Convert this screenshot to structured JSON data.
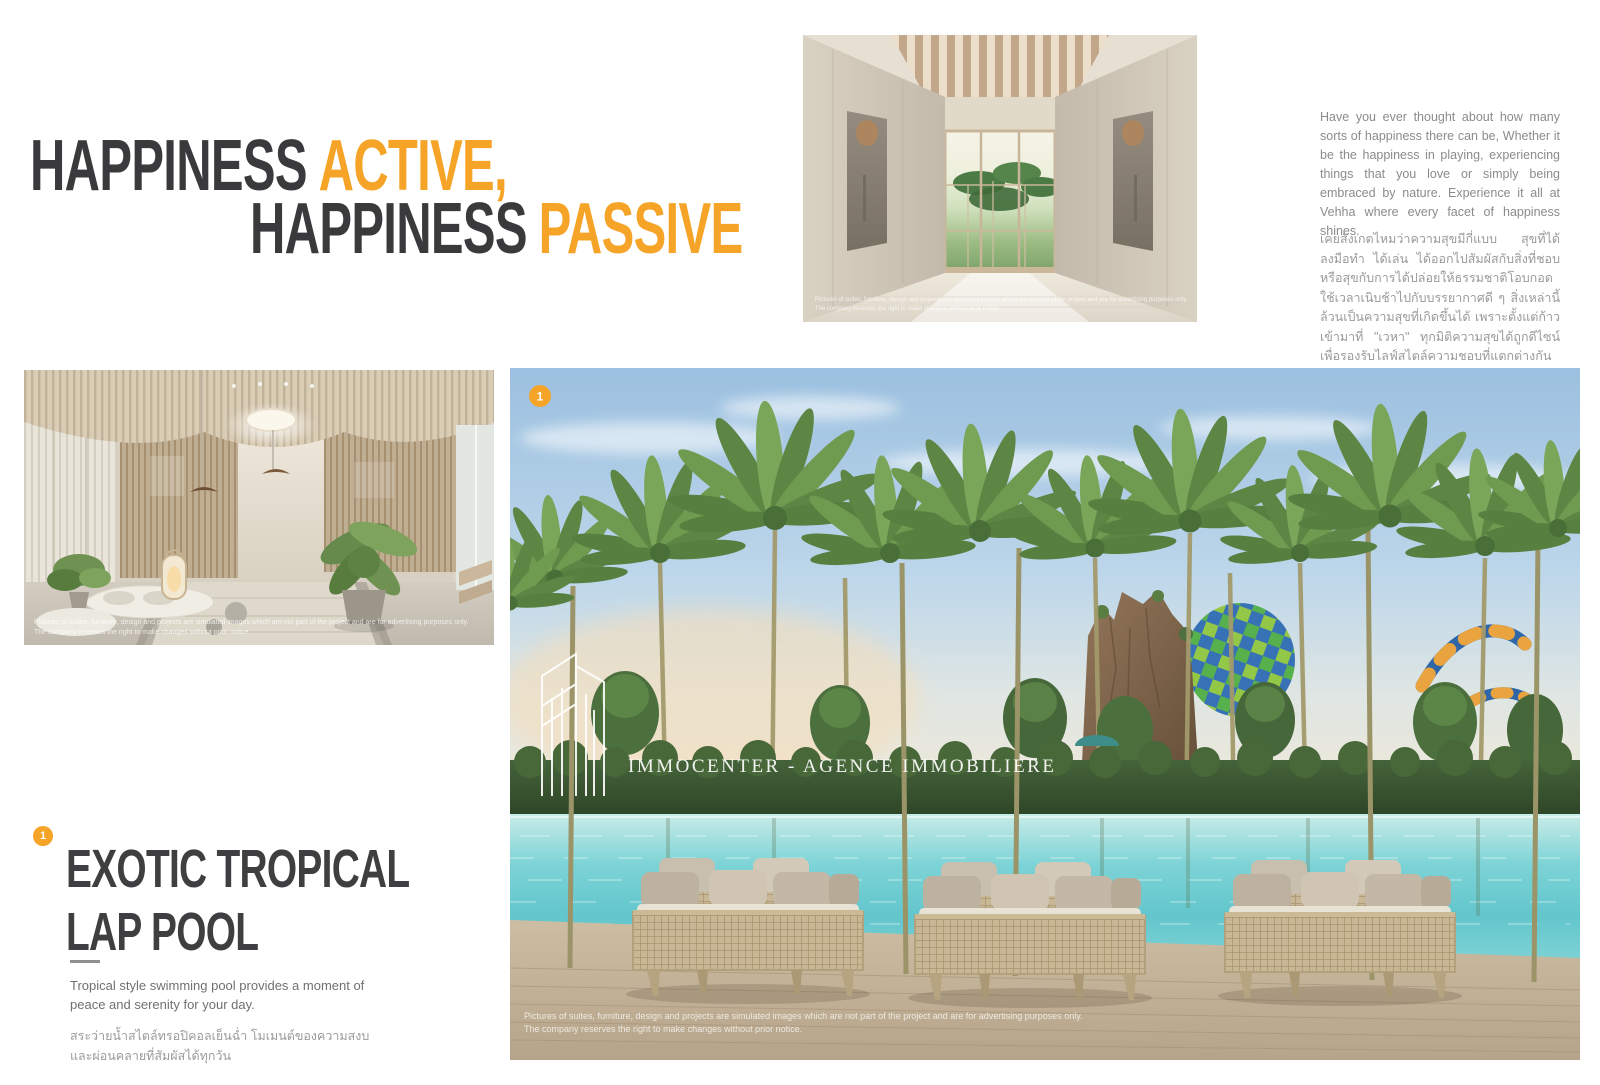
{
  "palette": {
    "accent_orange": "#f5a427",
    "headline_dark": "#3a3a3c",
    "pool_water": "#6fd0d4"
  },
  "headline": {
    "line1_dark": "HAPPINESS",
    "line1_orange": "ACTIVE,",
    "line2_dark": "HAPPINESS",
    "line2_orange": "PASSIVE"
  },
  "intro": {
    "english": "Have you ever thought about how many sorts of happiness there can be, Whether it be the happiness in playing, experiencing things that you love or simply being embraced by nature. Experience it all at Vehha where every facet of happiness shines.",
    "thai": "เคยสังเกตไหมว่าความสุขมีกี่แบบ สุขที่ได้ลงมือทำ ได้เล่น ได้ออกไปสัมผัสกับสิ่งที่ชอบ หรือสุขกับการได้ปล่อยให้ธรรมชาติโอบกอด ใช้เวลาเนิบช้าไปกับบรรยากาศดี ๆ สิ่งเหล่านี้ล้วนเป็นความสุขที่เกิดขึ้นได้ เพราะตั้งแต่ก้าวเข้ามาที่ \"เวหา\" ทุกมิติความสุขได้ถูกดีไซน์เพื่อรองรับไลฟ์สไตล์ความชอบที่แตกต่างกันอย่างครบถ้วน"
  },
  "watermark": {
    "text": "IMMOCENTER - AGENCE IMMOBILIERE"
  },
  "disclaimer": {
    "line1": "Pictures of suites, furniture, design and projects are simulated images which are not part of the project and are for advertising purposes only.",
    "line2": "The company reserves the right to make changes without prior notice."
  },
  "pool_image": {
    "badge": "1"
  },
  "feature": {
    "badge": "1",
    "title_line1": "EXOTIC TROPICAL",
    "title_line2": "LAP POOL",
    "english": "Tropical style swimming pool provides a moment of peace and serenity for your day.",
    "thai_line1": "สระว่ายน้ำสไตล์ทรอปิคอลเย็นฉ่ำ โมเมนต์ของความสงบ",
    "thai_line2": "และผ่อนคลายที่สัมผัสได้ทุกวัน"
  }
}
